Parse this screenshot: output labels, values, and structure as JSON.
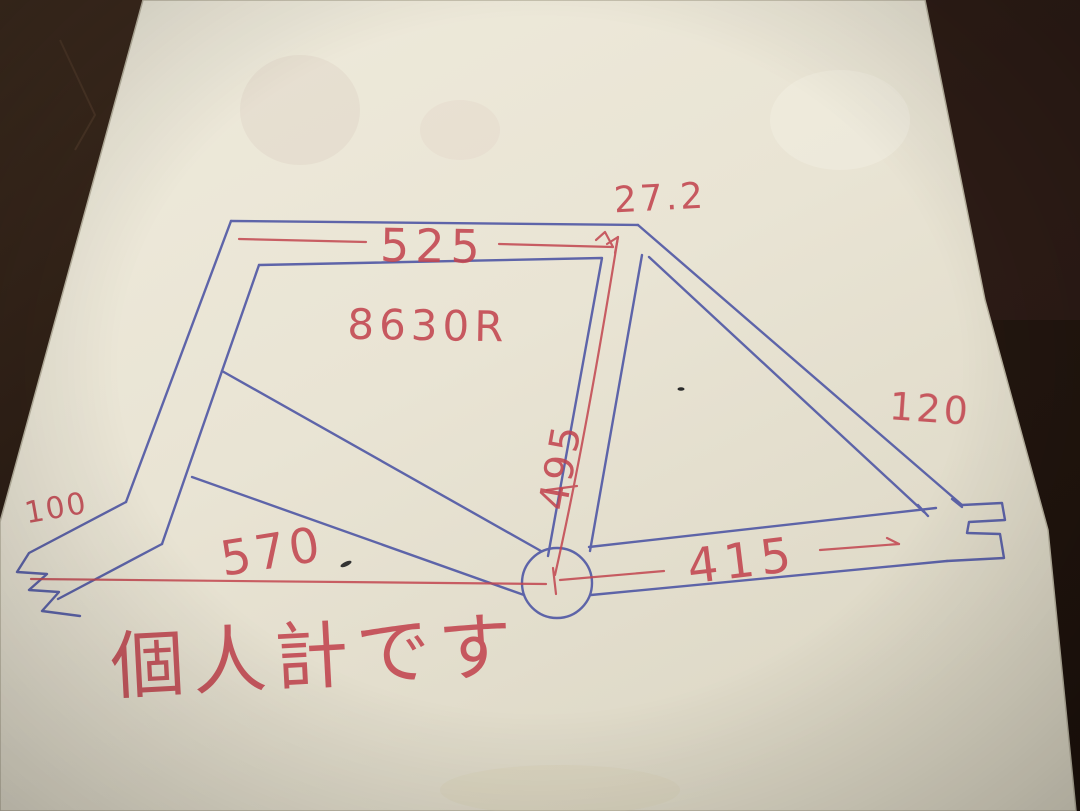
{
  "scene": {
    "description": "Hand-drawn bicycle frame geometry sketch in blue and red pen on cream paper, photographed on a dark wooden table",
    "colors": {
      "paper": "#e9e4d4",
      "table": "#261911",
      "ink_blue": "#4f57a5",
      "ink_red": "#c2454f"
    }
  },
  "labels": {
    "seatpost_diameter": "27.2",
    "top_tube_length": "525",
    "tubing_spec": "8630R",
    "seat_tube_length": "495",
    "head_tube_length": "120",
    "fork_dim": "100",
    "bottom_span": "570",
    "chainstay_length": "415",
    "note": "個人計です"
  }
}
